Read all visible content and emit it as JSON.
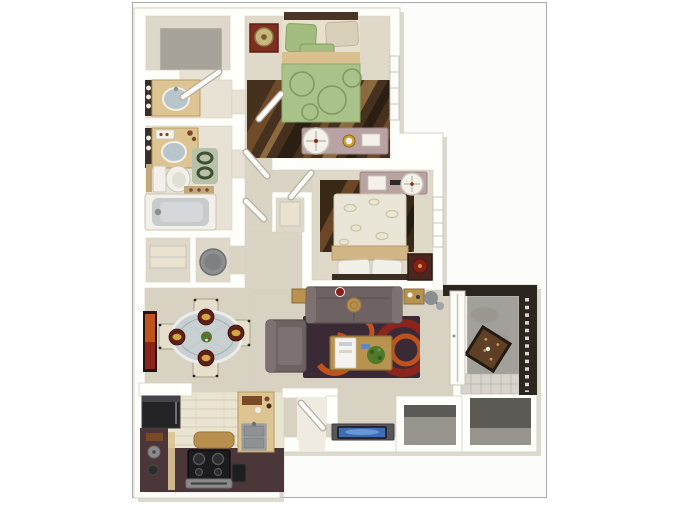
{
  "image": {
    "kind": "3d-floor-plan-top-down-rendering",
    "summary": {
      "bedrooms": 2,
      "beds": 2,
      "bathtubs": 1,
      "toilets": 1,
      "bathroom_sinks": 2,
      "dining_chairs": 4,
      "patios": 1
    }
  },
  "rooms": [
    {
      "id": "walk-in-closet",
      "contents": [
        "gray-carpet"
      ]
    },
    {
      "id": "vanity-room",
      "contents": [
        "vanity-counter",
        "oval-sink",
        "vanity-lights"
      ]
    },
    {
      "id": "bathroom",
      "contents": [
        "vanity-counter",
        "oval-sink",
        "toilet",
        "bathtub",
        "bath-rug",
        "shelf"
      ]
    },
    {
      "id": "storage-closets",
      "contents": [
        "shelf-box",
        "laundry-basket"
      ]
    },
    {
      "id": "hallway",
      "contents": [
        "doors"
      ]
    },
    {
      "id": "linen-closet",
      "contents": [
        "shelf"
      ]
    },
    {
      "id": "bedroom-1",
      "contents": [
        "green-double-bed",
        "red-nightstand",
        "table-lamp",
        "wood-tone-area-rug",
        "mauve-dresser",
        "round-mirror",
        "gold-clock",
        "window"
      ]
    },
    {
      "id": "bedroom-2",
      "contents": [
        "cream-double-bed",
        "dark-nightstand",
        "red-bowl",
        "brown-area-rug",
        "mauve-dresser",
        "round-mirror",
        "window"
      ]
    },
    {
      "id": "dining-area",
      "contents": [
        "glass-oval-table",
        "cream-chair",
        "cream-chair",
        "cream-chair",
        "cream-chair",
        "place-setting-x4",
        "centerpiece",
        "orange-wall-art"
      ]
    },
    {
      "id": "living-room",
      "contents": [
        "taupe-sofa",
        "armchair",
        "swirl-area-rug",
        "wood-coffee-table",
        "white-tray",
        "potted-plant",
        "end-table",
        "end-table",
        "gray-floor-lamp",
        "tv-console",
        "flat-tv"
      ]
    },
    {
      "id": "kitchen",
      "contents": [
        "refrigerator",
        "u-shaped-counter",
        "stove-with-burners",
        "oven-handle",
        "stainless-sink",
        "island-cabinet",
        "kettle",
        "cutting-board",
        "trash-bin",
        "floor-mat",
        "tile-floor"
      ]
    },
    {
      "id": "entry",
      "contents": [
        "front-door"
      ]
    },
    {
      "id": "patio",
      "contents": [
        "concrete-floor",
        "slatted-railing",
        "outdoor-table",
        "tile-pad"
      ]
    },
    {
      "id": "outdoor-storage",
      "contents": [
        "closet-a",
        "closet-b"
      ]
    }
  ],
  "colors": {
    "page_bg": "#ffffff",
    "plan_bg": "#fcfcfa",
    "plan_border": "#ababab",
    "shadow": "#cbc6b8",
    "wall": "#fefefb",
    "wall_edge": "#d6d1c4",
    "carpet_bed": "#ded9c9",
    "carpet_living": "#d7d2c2",
    "hall": "#d9d4c4",
    "tile_bath": "#e7e2d4",
    "tile_kitchen": "#eae4d2",
    "tile_line": "#d7d0bb",
    "entry": "#efebe0",
    "closet_carpet": "#a7a399",
    "storage_beige": "#ddd8ca",
    "patio_floor": "#a2a09a",
    "patio_mottle": "#908e88",
    "patio_tile": "#d7d4cb",
    "patio_tile_line": "#b5b2a8",
    "storage_floor": "#96948d",
    "storage_wall": "#5c5a54",
    "railing": "#2c2620",
    "railing_dot": "#d8d6d0",
    "counter": "#4b363a",
    "cabinet": "#dcc493",
    "cabinet_edge": "#b99a5e",
    "fridge": "#242426",
    "stove": "#1c1b1d",
    "stove_panel": "#8a8a8c",
    "steel": "#a8acae",
    "steel_dark": "#8e9294",
    "sofa": "#6e6263",
    "sofa_light": "#7d7172",
    "sofa_dark": "#5a5051",
    "rug_plum": "#3a2a36",
    "rug_plum_light": "#4e3a4a",
    "rug_orange": "#c2521c",
    "rug_red": "#8a241c",
    "wood": "#b8934f",
    "wood_dark": "#8a6a34",
    "tray": "#f4f3ef",
    "plant": "#4f7a2a",
    "chair": "#e5dfcc",
    "chair_edge": "#b2ab97",
    "glass": "#c8d0d3",
    "glass_rim": "#eef0ec",
    "glass_inner": "#a4aeb2",
    "placemat": "#5e1f16",
    "food": "#d2a93e",
    "frame_dark": "#21170f",
    "bed_green": "#a9c289",
    "bed_green_ring": "#7f9a5e",
    "bed_tan": "#d9c08e",
    "pillow_cream": "#d9d0ba",
    "pillow_green": "#a3bd80",
    "headboard": "#4a3527",
    "nightstand_red": "#7e2e1e",
    "lamp_tan": "#c9b67c",
    "mauve": "#b8a2a2",
    "mauve_edge": "#9a8686",
    "mirror": "#f3f1ea",
    "clock_gold": "#c9a23a",
    "rugwood_base": "#45311e",
    "rugwood_mid": "#6e4c2a",
    "rugwood_light": "#8a6a3e",
    "rugwood_dark": "#2a1f12",
    "bed2_cream": "#e9e6d8",
    "bed2_pat": "#c9c3a0",
    "bed2_tan": "#d2b686",
    "headboard2": "#3a2d22",
    "nightstand_dark": "#4a2620",
    "bowl_red": "#8a1f1a",
    "fixture": "#f2f0e8",
    "fixture_edge": "#c9c4b8",
    "tub_inner": "#c6cbce",
    "sink_blue": "#b9c5cc",
    "backsplash": "#3a2f28",
    "light_dot": "#f0eee8",
    "bath_rug": "#b7c2a8",
    "bath_ring": "#3f4f33",
    "towel": "#c2a878",
    "shelf_cream": "#e8e2cf",
    "basket": "#8d8f91",
    "basket_edge": "#6e7072",
    "tv_console": "#57565a",
    "tv_screen": "#3e6db5",
    "tv_glow": "#6fa0d8",
    "door": "#fdfcf9",
    "door_edge": "#b5aea0",
    "ptable": "#5f4026",
    "ptable_edge": "#241a12",
    "ptable_dot": "#c89a5e",
    "mat": "#b98f4e",
    "bin": "#1e1e20",
    "item_brown": "#7a4a26",
    "lamp_gray": "#8b8e90"
  }
}
